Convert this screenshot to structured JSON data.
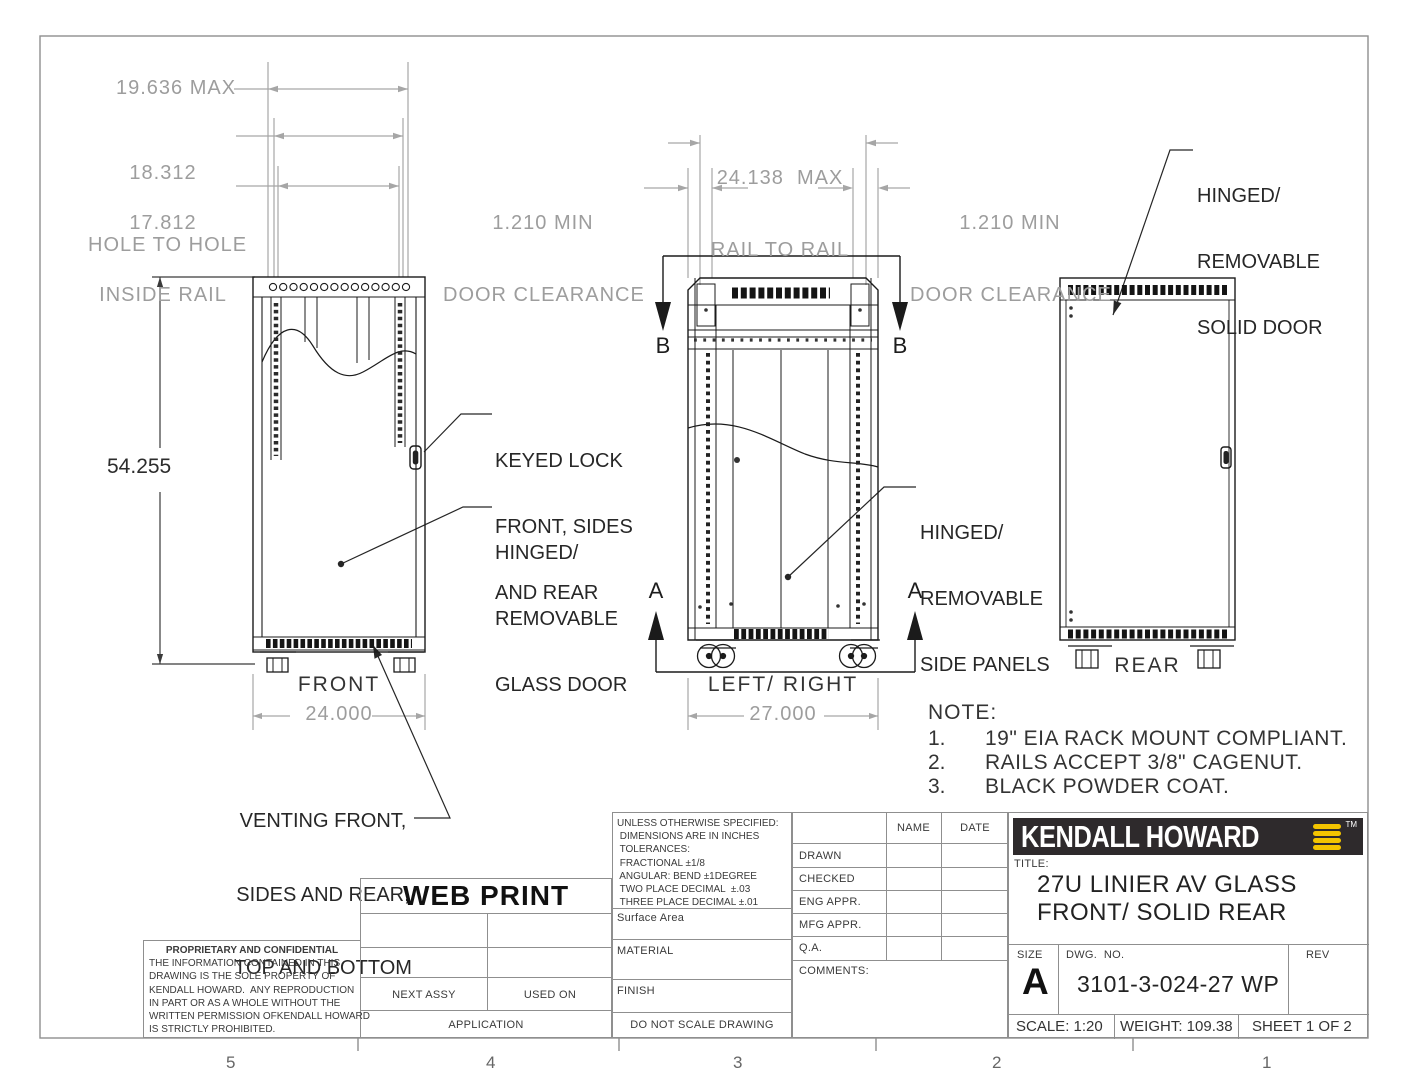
{
  "colors": {
    "line_dark": "#1b1b1b",
    "dim_gray": "#a6a6a6",
    "title_block_line": "#8f8f8f",
    "brand_bar": "#2e2a2c",
    "brand_yellow": "#f3c400"
  },
  "zones": [
    "5",
    "4",
    "3",
    "2",
    "1"
  ],
  "dims": {
    "max_width": "19.636 MAX",
    "hole_to_hole": [
      "18.312",
      "HOLE TO HOLE"
    ],
    "inside_rail": [
      "17.812",
      "INSIDE RAIL"
    ],
    "rail_to_rail": [
      "24.138  MAX",
      "RAIL TO RAIL"
    ],
    "door_clearance_left": [
      "1.210 MIN",
      "DOOR CLEARANCE"
    ],
    "door_clearance_right": [
      "1.210 MIN",
      "DOOR CLEARANCE"
    ],
    "height": "54.255",
    "front_width": "24.000",
    "side_depth": "27.000"
  },
  "views": {
    "front": "FRONT",
    "side": "LEFT/ RIGHT",
    "rear": "REAR"
  },
  "sections": {
    "a": "A",
    "b": "B"
  },
  "callouts": {
    "keyed_lock": [
      "KEYED LOCK",
      "FRONT, SIDES",
      "AND REAR"
    ],
    "glass_door": [
      "HINGED/",
      "REMOVABLE",
      "GLASS DOOR"
    ],
    "side_panels": [
      "HINGED/",
      "REMOVABLE",
      "SIDE PANELS"
    ],
    "solid_door": [
      "HINGED/",
      "REMOVABLE",
      "SOLID DOOR"
    ],
    "venting": [
      "VENTING FRONT,",
      "SIDES AND REAR,",
      "TOP AND BOTTOM"
    ]
  },
  "note": {
    "heading": "NOTE:",
    "items": [
      {
        "num": "1.",
        "text": "19\" EIA RACK MOUNT COMPLIANT."
      },
      {
        "num": "2.",
        "text": "RAILS ACCEPT 3/8\" CAGENUT."
      },
      {
        "num": "3.",
        "text": "BLACK POWDER COAT."
      }
    ]
  },
  "title_block": {
    "web_print": "WEB PRINT",
    "next_assy": "NEXT ASSY",
    "used_on": "USED ON",
    "application": "APPLICATION",
    "proprietary": {
      "heading": "PROPRIETARY AND CONFIDENTIAL",
      "lines": [
        "THE INFORMATION CONTAINED IN THIS",
        "DRAWING IS THE SOLE PROPERTY OF",
        "KENDALL HOWARD.  ANY REPRODUCTION",
        "IN PART OR AS A WHOLE WITHOUT THE",
        "WRITTEN PERMISSION OFKENDALL HOWARD",
        "IS STRICTLY PROHIBITED."
      ]
    },
    "tolerances": {
      "lines": [
        "UNLESS OTHERWISE SPECIFIED:",
        " DIMENSIONS ARE IN INCHES",
        " TOLERANCES:",
        " FRACTIONAL ±1/8",
        " ANGULAR: BEND ±1DEGREE",
        " TWO PLACE DECIMAL  ±.03",
        " THREE PLACE DECIMAL ±.01"
      ],
      "surface_area": "Surface Area",
      "material": "MATERIAL",
      "finish": "FINISH",
      "do_not_scale": "DO NOT SCALE DRAWING"
    },
    "approvals": {
      "name": "NAME",
      "date": "DATE",
      "rows": [
        "DRAWN",
        "CHECKED",
        "ENG APPR.",
        "MFG APPR.",
        "Q.A."
      ],
      "comments": "COMMENTS:"
    },
    "brand": {
      "logo": "KENDALL HOWARD",
      "tm": "TM"
    },
    "title_label": "TITLE:",
    "title_lines": [
      "27U LINIER AV GLASS",
      "FRONT/ SOLID REAR"
    ],
    "size_label": "SIZE",
    "size": "A",
    "dwg_label": "DWG.  NO.",
    "dwg_no": "3101-3-024-27 WP",
    "rev_label": "REV",
    "scale": "SCALE: 1:20",
    "weight": "WEIGHT: 109.38",
    "sheet": "SHEET 1 OF 2"
  }
}
